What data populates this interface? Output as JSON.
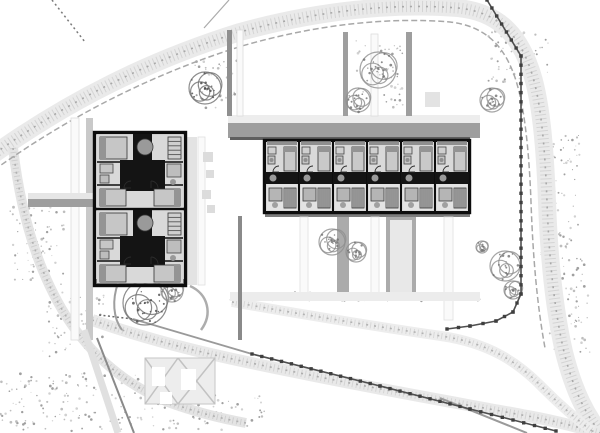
{
  "meta": {
    "kind": "architectural-site-plan",
    "width": 600,
    "height": 433,
    "background": "#ffffff"
  },
  "palette": {
    "wall": "#0d0d0d",
    "poche": "#141414",
    "interior": "#d9d9d9",
    "furniture_light": "#c6c6c6",
    "furniture_mid": "#9a9a9a",
    "band_light": "#eaeaea",
    "band_dot": "#d4d4d4",
    "band_tick": "#a8a8a8",
    "fence": "#4f4f4f",
    "post": "#3f3f3f",
    "speckle1": "#c9c9c9",
    "speckle2": "#b3b3b3",
    "speckle3": "#8f8f8f",
    "tree_stroke": "#8f8f8f",
    "tree_dark": "#6f6f6f"
  },
  "site": {
    "roads": [
      {
        "name": "perimeter-band",
        "d": "M -6,154 C 70,100 150,60 240,32 C 320,10 395,3 458,8 C 498,12 518,34 530,68 C 541,98 545,148 547,202 C 549,258 554,308 564,352 C 574,392 587,417 603,436",
        "w": 18,
        "c": "#eaeaea",
        "o1": "#d4d4d4",
        "o2": "#a8a8a8"
      },
      {
        "name": "west-edge-band",
        "d": "M 13,148 C 20,208 36,268 66,316 C 92,357 128,386 168,402 C 198,413 224,419 246,423",
        "w": 10,
        "c": "#e4e4e4",
        "o1": "#cfcfcf",
        "o2": "#b0b0b0"
      },
      {
        "name": "south-road-band",
        "d": "M 92,320 C 160,344 225,358 295,372 C 372,388 452,402 522,415 C 552,420 577,427 600,433",
        "w": 12,
        "c": "#e9e9e9",
        "o1": "#d4d4d4",
        "o2": "#adadad"
      },
      {
        "name": "south-road-band-2",
        "d": "M 232,302 C 300,314 372,326 441,336 C 489,343 518,362 543,388 C 559,404 576,419 592,431",
        "w": 10,
        "c": "#ededed",
        "o1": "#d8d8d8",
        "o2": "#b3b3b3"
      }
    ],
    "boundaries": [
      {
        "name": "boundary-inner",
        "d": "M -6,170 C 70,116 152,74 242,46 C 318,24 390,17 450,22 C 484,26 502,44 513,72 C 524,100 529,148 531,202 C 533,258 537,304 545,348",
        "w": 1.5,
        "c": "#a8a8a8",
        "dash": "6 3"
      }
    ],
    "strips": [
      {
        "name": "walkway-north-light",
        "x": 228,
        "y": 115,
        "w": 252,
        "h": 8,
        "f": "#ededed"
      },
      {
        "name": "walkway-north-gray",
        "x": 228,
        "y": 123,
        "w": 252,
        "h": 15,
        "f": "#9e9e9e"
      },
      {
        "name": "north-wall-shadow",
        "x": 230,
        "y": 137,
        "w": 240,
        "h": 3,
        "f": "#5f5f5f"
      },
      {
        "name": "utility-line-1",
        "x": 227,
        "y": 30,
        "w": 5,
        "h": 86,
        "f": "#8f8f8f"
      },
      {
        "name": "path-vertical-1",
        "x": 237,
        "y": 30,
        "w": 6,
        "h": 86,
        "f": "#fafafa",
        "s": "#dddddd"
      },
      {
        "name": "utility-line-2",
        "x": 343,
        "y": 32,
        "w": 5,
        "h": 84,
        "f": "#9e9e9e"
      },
      {
        "name": "path-vertical-2",
        "x": 371,
        "y": 34,
        "w": 7,
        "h": 82,
        "f": "#fafafa",
        "s": "#dddddd"
      },
      {
        "name": "utility-line-3",
        "x": 406,
        "y": 32,
        "w": 6,
        "h": 84,
        "f": "#9e9e9e"
      },
      {
        "name": "path-west",
        "x": 71,
        "y": 118,
        "w": 8,
        "h": 222,
        "f": "#fafafa",
        "s": "#dddddd"
      },
      {
        "name": "strip-west",
        "x": 86,
        "y": 118,
        "w": 7,
        "h": 222,
        "f": "#c9c9c9"
      },
      {
        "name": "walkway-left-light",
        "x": 28,
        "y": 193,
        "w": 67,
        "h": 6,
        "f": "#e6e6e6"
      },
      {
        "name": "walkway-left-gray",
        "x": 28,
        "y": 199,
        "w": 67,
        "h": 8,
        "f": "#9e9e9e"
      },
      {
        "name": "strip-east-of-left-building",
        "x": 185,
        "y": 137,
        "w": 12,
        "h": 148,
        "f": "#e3e3e3"
      },
      {
        "name": "path-east-of-left-building",
        "x": 198,
        "y": 137,
        "w": 7,
        "h": 148,
        "f": "#fafafa",
        "s": "#e0e0e0"
      },
      {
        "name": "pad-1",
        "x": 203,
        "y": 152,
        "w": 10,
        "h": 10,
        "f": "#dcdcdc"
      },
      {
        "name": "pad-2",
        "x": 206,
        "y": 170,
        "w": 8,
        "h": 8,
        "f": "#dcdcdc"
      },
      {
        "name": "pad-3",
        "x": 202,
        "y": 190,
        "w": 9,
        "h": 9,
        "f": "#dcdcdc"
      },
      {
        "name": "pad-4",
        "x": 207,
        "y": 205,
        "w": 8,
        "h": 8,
        "f": "#dcdcdc"
      },
      {
        "name": "pad-5",
        "x": 425,
        "y": 92,
        "w": 15,
        "h": 15,
        "f": "#e3e3e3"
      },
      {
        "name": "south-wall-shadow",
        "x": 265,
        "y": 212,
        "w": 205,
        "h": 5,
        "f": "#7d7d7d"
      },
      {
        "name": "path-south-1",
        "x": 300,
        "y": 217,
        "w": 8,
        "h": 80,
        "f": "#fafafa",
        "s": "#e0e0e0"
      },
      {
        "name": "strip-south-1",
        "x": 337,
        "y": 217,
        "w": 12,
        "h": 83,
        "f": "#ababab"
      },
      {
        "name": "path-south-2",
        "x": 371,
        "y": 217,
        "w": 8,
        "h": 80,
        "f": "#fafafa",
        "s": "#e0e0e0"
      },
      {
        "name": "strip-south-2",
        "x": 386,
        "y": 217,
        "w": 30,
        "h": 83,
        "f": "#ababab"
      },
      {
        "name": "strip-south-2-inner",
        "x": 390,
        "y": 220,
        "w": 22,
        "h": 77,
        "f": "#e8e8e8"
      },
      {
        "name": "path-south-3",
        "x": 444,
        "y": 217,
        "w": 9,
        "h": 103,
        "f": "#fafafa",
        "s": "#e0e0e0"
      },
      {
        "name": "walkway-south",
        "x": 230,
        "y": 292,
        "w": 250,
        "h": 9,
        "f": "#ececec"
      },
      {
        "name": "left-building-sill",
        "x": 95,
        "y": 279,
        "w": 90,
        "h": 6,
        "f": "#8f8f8f"
      },
      {
        "name": "divider-line",
        "x": 238,
        "y": 216,
        "w": 4,
        "h": 124,
        "f": "#8a8a8a"
      }
    ],
    "segments": [
      {
        "name": "corner-dotted-line",
        "x1": 52,
        "y1": 0,
        "x2": 85,
        "y2": 42,
        "w": 1.5,
        "c": "#7a7a7a",
        "dash": "2 3"
      },
      {
        "name": "top-spur-line",
        "x1": 204,
        "y1": 28,
        "x2": 229,
        "y2": 0,
        "w": 1.2,
        "c": "#ababab"
      },
      {
        "name": "southwest-road-edge",
        "x1": 97,
        "y1": 338,
        "x2": 134,
        "y2": 433,
        "w": 2,
        "c": "#8a8a8a"
      },
      {
        "name": "southwest-road-band",
        "x1": 84,
        "y1": 330,
        "x2": 118,
        "y2": 433,
        "w": 7,
        "c": "#e0e0e0"
      },
      {
        "name": "dotted-tick-line",
        "x1": 99,
        "y1": 315,
        "x2": 133,
        "y2": 319,
        "w": 1.5,
        "c": "#6a6a6a",
        "dash": "2 2.5"
      },
      {
        "name": "mid-road-edge",
        "x1": 133,
        "y1": 319,
        "x2": 252,
        "y2": 354,
        "w": 1.8,
        "c": "#9a9a9a"
      },
      {
        "name": "southeast-road-edge",
        "x1": 440,
        "y1": 398,
        "x2": 527,
        "y2": 433,
        "w": 2,
        "c": "#9a9a9a"
      }
    ],
    "curves": [
      {
        "name": "tree-hook-east",
        "d": "M 190,286 C 208,294 213,314 201,330",
        "c": "#adadad",
        "w": 2.5
      },
      {
        "name": "tree-hook-west",
        "d": "M 118,283 C 112,300 113,318 122,330",
        "c": "#9e9e9e",
        "w": 2
      }
    ],
    "fences": [
      {
        "name": "fence-east",
        "pts": [
          [
            487,
            0
          ],
          [
            521,
            56
          ],
          [
            521,
            294
          ],
          [
            513,
            312
          ],
          [
            496,
            321
          ],
          [
            470,
            326
          ],
          [
            447,
            329
          ]
        ],
        "sp": 9
      },
      {
        "name": "fence-south",
        "pts": [
          [
            252,
            354
          ],
          [
            380,
            386
          ],
          [
            470,
            409
          ],
          [
            556,
            431
          ]
        ],
        "sp": 10
      }
    ],
    "speckle_patches": [
      {
        "x": 10,
        "y": 200,
        "w": 55,
        "h": 85,
        "n": 70
      },
      {
        "x": 40,
        "y": 288,
        "w": 65,
        "h": 70,
        "n": 70
      },
      {
        "x": 0,
        "y": 373,
        "w": 145,
        "h": 58,
        "n": 130
      },
      {
        "x": 150,
        "y": 392,
        "w": 115,
        "h": 38,
        "n": 60
      },
      {
        "x": 540,
        "y": 135,
        "w": 40,
        "h": 120,
        "n": 80
      },
      {
        "x": 548,
        "y": 258,
        "w": 42,
        "h": 95,
        "n": 70
      },
      {
        "x": 488,
        "y": 28,
        "w": 62,
        "h": 58,
        "n": 50
      },
      {
        "x": 390,
        "y": 220,
        "w": 22,
        "h": 77,
        "n": 55
      },
      {
        "x": 230,
        "y": 292,
        "w": 250,
        "h": 9,
        "n": 70
      },
      {
        "x": 356,
        "y": 38,
        "w": 48,
        "h": 70,
        "n": 60
      },
      {
        "x": 195,
        "y": 60,
        "w": 45,
        "h": 50,
        "n": 45
      }
    ],
    "trees": [
      {
        "x": 205,
        "y": 88,
        "r": 16,
        "dark": true
      },
      {
        "x": 378,
        "y": 70,
        "r": 18
      },
      {
        "x": 358,
        "y": 100,
        "r": 12
      },
      {
        "x": 492,
        "y": 100,
        "r": 12
      },
      {
        "x": 145,
        "y": 303,
        "r": 22,
        "dark": true
      },
      {
        "x": 172,
        "y": 291,
        "r": 11
      },
      {
        "x": 332,
        "y": 242,
        "r": 13
      },
      {
        "x": 356,
        "y": 252,
        "r": 10
      },
      {
        "x": 505,
        "y": 266,
        "r": 15
      },
      {
        "x": 513,
        "y": 290,
        "r": 9
      },
      {
        "x": 482,
        "y": 247,
        "r": 6
      }
    ],
    "parking_boxes": {
      "x": 145,
      "y": 358,
      "w": 70,
      "h": 46,
      "divider": 178,
      "fill": "#ededed",
      "stroke": "#c6c6c6",
      "cross": "#c2c2c2",
      "holes": [
        [
          152,
          367,
          13,
          19
        ],
        [
          181,
          369,
          15,
          21
        ],
        [
          160,
          392,
          12,
          12
        ]
      ]
    }
  },
  "buildings": {
    "left": {
      "name": "apartment-block-west",
      "x": 95,
      "y": 133,
      "cols": 1,
      "rows": 2,
      "uw": 90,
      "uh": 76,
      "stamp": [
        {
          "t": "rect",
          "x": 2,
          "y": 2,
          "w": 86,
          "h": 72,
          "f": "#d9d9d9"
        },
        {
          "t": "rect",
          "x": 0,
          "y": 0,
          "w": 90,
          "h": 76,
          "s": "#0d0d0d",
          "sw": 2.4
        },
        {
          "t": "line",
          "x1": 2,
          "y1": 29,
          "x2": 88,
          "y2": 29,
          "c": "#0d0d0d",
          "w": 1.4
        },
        {
          "t": "line",
          "x1": 2,
          "y1": 52,
          "x2": 88,
          "y2": 52,
          "c": "#0d0d0d",
          "w": 1.4
        },
        {
          "t": "rect",
          "x": 38,
          "y": 1,
          "w": 19,
          "h": 26,
          "f": "#141414"
        },
        {
          "t": "rect",
          "x": 25,
          "y": 27,
          "w": 45,
          "h": 31,
          "f": "#141414"
        },
        {
          "t": "circle",
          "cx": 50,
          "cy": 14,
          "r": 8,
          "f": "#9a9a9a",
          "s": "#3a3a3a"
        },
        {
          "t": "rect",
          "x": 5,
          "y": 4,
          "w": 27,
          "h": 22,
          "f": "#c6c6c6",
          "s": "#333333"
        },
        {
          "t": "rect",
          "x": 5,
          "y": 4,
          "w": 6,
          "h": 22,
          "f": "#949494"
        },
        {
          "t": "rect",
          "x": 73,
          "y": 4,
          "w": 13,
          "h": 22,
          "f": "#cfcfcf",
          "s": "#333333"
        },
        {
          "t": "stripes",
          "x": 73,
          "y": 4,
          "w": 13,
          "h": 22,
          "n": 5,
          "dir": "h",
          "c": "#555555"
        },
        {
          "t": "rect",
          "x": 5,
          "y": 31,
          "w": 13,
          "h": 9,
          "f": "#c6c6c6",
          "s": "#444444"
        },
        {
          "t": "rect",
          "x": 5,
          "y": 42,
          "w": 9,
          "h": 8,
          "f": "#bdbdbd",
          "s": "#444444"
        },
        {
          "t": "rect",
          "x": 72,
          "y": 31,
          "w": 14,
          "h": 13,
          "f": "#bdbdbd",
          "s": "#444444"
        },
        {
          "t": "circle",
          "cx": 78,
          "cy": 49,
          "r": 3,
          "f": "#999999"
        },
        {
          "t": "rect",
          "x": 5,
          "y": 56,
          "w": 26,
          "h": 17,
          "f": "#c6c6c6",
          "s": "#333333"
        },
        {
          "t": "rect",
          "x": 5,
          "y": 56,
          "w": 6,
          "h": 17,
          "f": "#949494"
        },
        {
          "t": "rect",
          "x": 59,
          "y": 56,
          "w": 26,
          "h": 17,
          "f": "#c6c6c6",
          "s": "#333333"
        },
        {
          "t": "rect",
          "x": 79,
          "y": 56,
          "w": 6,
          "h": 17,
          "f": "#949494"
        },
        {
          "t": "arc",
          "cx": 36,
          "cy": 55,
          "r": 7,
          "a0": 180,
          "a1": 270
        },
        {
          "t": "arc",
          "cx": 56,
          "cy": 55,
          "r": 7,
          "a0": 270,
          "a1": 360
        }
      ]
    },
    "right": {
      "name": "terrace-block-east",
      "x": 265,
      "y": 141,
      "cols": 6,
      "rows": 1,
      "uw": 34,
      "uh": 71,
      "stamp": [
        {
          "t": "rect",
          "x": 1,
          "y": 1,
          "w": 32,
          "h": 69,
          "f": "#d9d9d9"
        },
        {
          "t": "rect",
          "x": 0,
          "y": 0,
          "w": 34,
          "h": 71,
          "s": "#0d0d0d",
          "sw": 2
        },
        {
          "t": "rect",
          "x": 2,
          "y": 0,
          "w": 30,
          "h": 4,
          "f": "#8f8f8f"
        },
        {
          "t": "rect",
          "x": 3,
          "y": 6,
          "w": 8,
          "h": 7,
          "f": "#cfcfcf",
          "s": "#444444"
        },
        {
          "t": "rect",
          "x": 3,
          "y": 15,
          "w": 7,
          "h": 8,
          "f": "#c4c4c4",
          "s": "#444444"
        },
        {
          "t": "circle",
          "cx": 6.5,
          "cy": 19,
          "r": 2,
          "f": "#8f8f8f"
        },
        {
          "t": "rect",
          "x": 19,
          "y": 6,
          "w": 12,
          "h": 24,
          "f": "#c9c9c9",
          "s": "#333333"
        },
        {
          "t": "rect",
          "x": 19,
          "y": 6,
          "w": 12,
          "h": 5,
          "f": "#949494"
        },
        {
          "t": "rect",
          "x": 0,
          "y": 31,
          "w": 34,
          "h": 12,
          "f": "#141414"
        },
        {
          "t": "circle",
          "cx": 8,
          "cy": 37,
          "r": 3.5,
          "f": "#9a9a9a"
        },
        {
          "t": "arc",
          "cx": 14,
          "cy": 31,
          "r": 6,
          "a0": 180,
          "a1": 270
        },
        {
          "t": "rect",
          "x": 2,
          "y": 43,
          "w": 30,
          "h": 26,
          "f": "#e3e3e3"
        },
        {
          "t": "rect",
          "x": 4,
          "y": 47,
          "w": 13,
          "h": 13,
          "f": "#b5b5b5",
          "s": "#3a3a3a"
        },
        {
          "t": "circle",
          "cx": 10,
          "cy": 64,
          "r": 3,
          "f": "#a0a0a0"
        },
        {
          "t": "rect",
          "x": 19,
          "y": 47,
          "w": 12,
          "h": 20,
          "f": "#d2d2d2",
          "s": "#333333"
        },
        {
          "t": "stripes",
          "x": 19,
          "y": 47,
          "w": 12,
          "h": 20,
          "n": 6,
          "dir": "v",
          "c": "#4a4a4a"
        }
      ]
    }
  }
}
